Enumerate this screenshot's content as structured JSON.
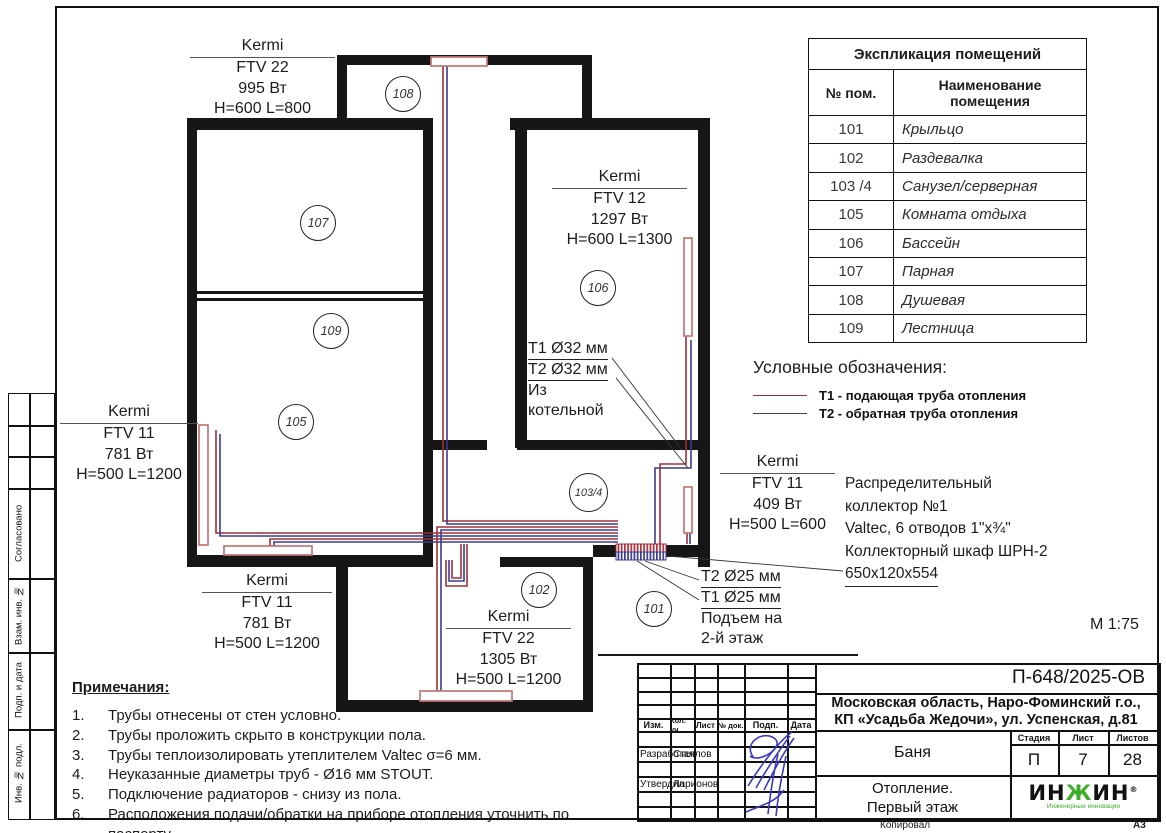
{
  "frame": {
    "copied": "Копировал",
    "format": "А3",
    "side": {
      "agreed": "Согласовано",
      "vzam": "Взам. инв. №",
      "podp": "Подп. и дата",
      "inv": "Инв. № подл."
    }
  },
  "explication": {
    "title": "Экспликация помещений",
    "col_num": "№ пом.",
    "col_name": "Наименование помещения",
    "rows": [
      {
        "num": "101",
        "name": "Крыльцо"
      },
      {
        "num": "102",
        "name": "Раздевалка"
      },
      {
        "num": "103 /4",
        "name": "Санузел/серверная"
      },
      {
        "num": "105",
        "name": "Комната отдыха"
      },
      {
        "num": "106",
        "name": "Бассейн"
      },
      {
        "num": "107",
        "name": "Парная"
      },
      {
        "num": "108",
        "name": "Душевая"
      },
      {
        "num": "109",
        "name": "Лестница"
      }
    ]
  },
  "legend": {
    "title": "Условные обозначения:",
    "t1": "Т1 - подающая труба отопления",
    "t2": "Т2 - обратная труба отопления"
  },
  "plan": {
    "scale": "М 1:75",
    "circles": [
      "108",
      "107",
      "109",
      "105",
      "106",
      "103/4",
      "102",
      "101"
    ],
    "radiator_labels": [
      {
        "brand": "Kermi",
        "model": "FTV 22",
        "power": "995 Вт",
        "size": "H=600 L=800"
      },
      {
        "brand": "Kermi",
        "model": "FTV 12",
        "power": "1297 Вт",
        "size": "H=600 L=1300"
      },
      {
        "brand": "Kermi",
        "model": "FTV 11",
        "power": "781 Вт",
        "size": "H=500 L=1200"
      },
      {
        "brand": "Kermi",
        "model": "FTV 11",
        "power": "781 Вт",
        "size": "H=500 L=1200"
      },
      {
        "brand": "Kermi",
        "model": "FTV 22",
        "power": "1305 Вт",
        "size": "H=500 L=1200"
      },
      {
        "brand": "Kermi",
        "model": "FTV 11",
        "power": "409 Вт",
        "size": "H=500 L=600"
      }
    ],
    "supply": {
      "l1": "Т1 Ø32 мм",
      "l2": "Т2 Ø32 мм",
      "l3": "Из",
      "l4": "котельной"
    },
    "riser": {
      "l1": "Т2 Ø25 мм",
      "l2": "Т1 Ø25 мм",
      "l3": "Подъем на",
      "l4": "2-й этаж"
    },
    "collector": {
      "l1": "Распределительный",
      "l2": "коллектор №1",
      "l3": "Valtec, 6 отводов 1\"x¾\"",
      "l4": "Коллекторный шкаф ШРН-2",
      "l5": "650x120x554"
    }
  },
  "notes": {
    "title": "Примечания:",
    "items": [
      {
        "n": "1.",
        "text": "Трубы отнесены от стен условно."
      },
      {
        "n": "2.",
        "text": "Трубы проложить скрыто в конструкции пола."
      },
      {
        "n": "3.",
        "text": "Трубы теплоизолировать утеплителем Valtec σ=6 мм."
      },
      {
        "n": "4.",
        "text": "Неуказанные диаметры труб - Ø16 мм STOUT."
      },
      {
        "n": "5.",
        "text": "Подключение радиаторов - снизу из пола."
      },
      {
        "n": "6.",
        "text": "Расположения подачи/обратки на приборе отопления уточнить по паспорту."
      }
    ]
  },
  "titleblock": {
    "code": "П-648/2025-ОВ",
    "address1": "Московская область, Наро-Фоминский г.о.,",
    "address2": "КП «Усадьба Жедочи», ул. Успенская, д.81",
    "object": "Баня",
    "stage_label": "Стадия",
    "sheet_label": "Лист",
    "sheets_label": "Листов",
    "stage": "П",
    "sheet_no": "7",
    "sheets_total": "28",
    "drawing1": "Отопление.",
    "drawing2": "Первый этаж",
    "role1": "Разработал",
    "name1": "Стеклов",
    "role2": "Утвердил",
    "name2": "Ларионов",
    "cols": [
      "Изм.",
      "Кол. уч",
      "Лист",
      "№ док.",
      "Подп.",
      "Дата"
    ],
    "logo": {
      "p1": "ИН",
      "p2": "Ж",
      "p3": "ИН",
      "reg": "®",
      "subtitle": "Инженерные инновации"
    }
  },
  "colors": {
    "t1_red": "#9e3039",
    "t2_blue": "#3c3c8c",
    "radiator_pink": "#c27575",
    "logo_green": "#3fae2a",
    "signature_blue": "#3b3bc0"
  }
}
